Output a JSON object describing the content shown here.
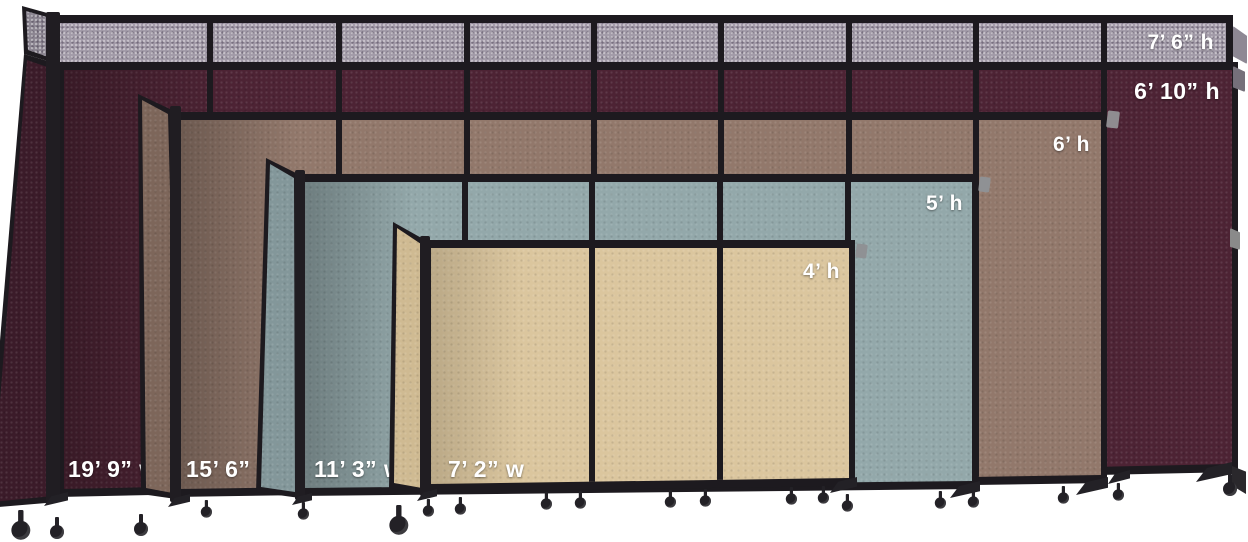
{
  "image_title": "Portable partition size comparison",
  "background_color": "#ffffff",
  "frame_color": "#1d1a1f",
  "label_text_color": "#ffffff",
  "partitions": [
    {
      "name": "gray-7ft-6in-partition",
      "fabric": "gray",
      "fabric_color": "#a19aa7",
      "height_label": "7’ 6” h"
    },
    {
      "name": "cranberry-6ft-10in-partition",
      "fabric": "cranberry",
      "fabric_color": "#4d2334",
      "height_label": "6’ 10” h",
      "width_label": "19’ 9” w"
    },
    {
      "name": "mocha-6ft-partition",
      "fabric": "mocha",
      "fabric_color": "#92786b",
      "height_label": "6’ h",
      "width_label": "15’ 6” w"
    },
    {
      "name": "ocean-5ft-partition",
      "fabric": "ocean",
      "fabric_color": "#93a8aa",
      "height_label": "5’ h",
      "width_label": "11’ 3” w"
    },
    {
      "name": "sand-4ft-partition",
      "fabric": "sand",
      "fabric_color": "#dbc69e",
      "height_label": "4’ h",
      "width_label": "7’ 2” w"
    }
  ]
}
